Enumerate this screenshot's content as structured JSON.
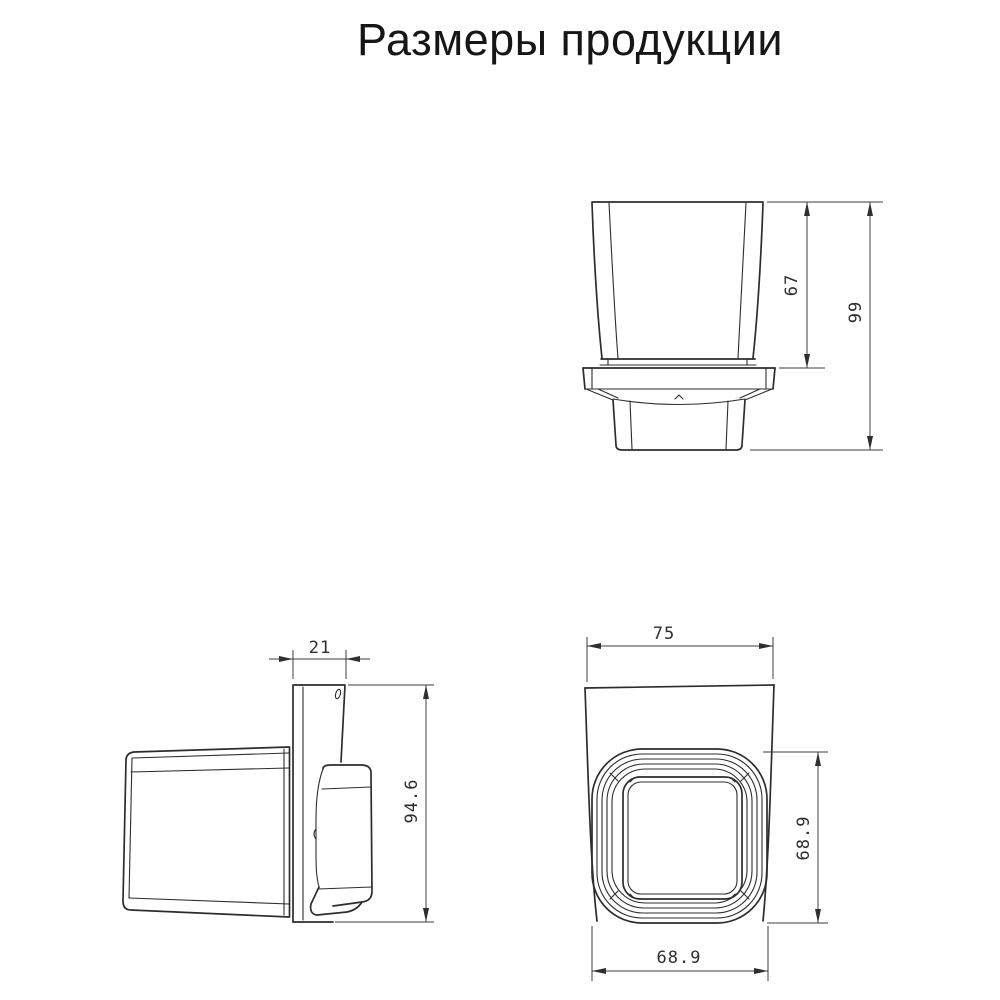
{
  "title": "Размеры продукции",
  "drawing": {
    "front_view": {
      "cup_height_mm": "67",
      "total_height_mm": "99"
    },
    "side_view": {
      "wall_plate_depth_mm": "21",
      "total_height_mm": "94.6"
    },
    "top_view": {
      "top_width_mm": "75",
      "rim_depth_mm": "68.9",
      "rim_width_mm": "68.9"
    }
  },
  "colors": {
    "line": "#2d2d2d",
    "dimension_line": "#3c3c3c",
    "text": "#2e2e2e",
    "background": "#ffffff"
  }
}
